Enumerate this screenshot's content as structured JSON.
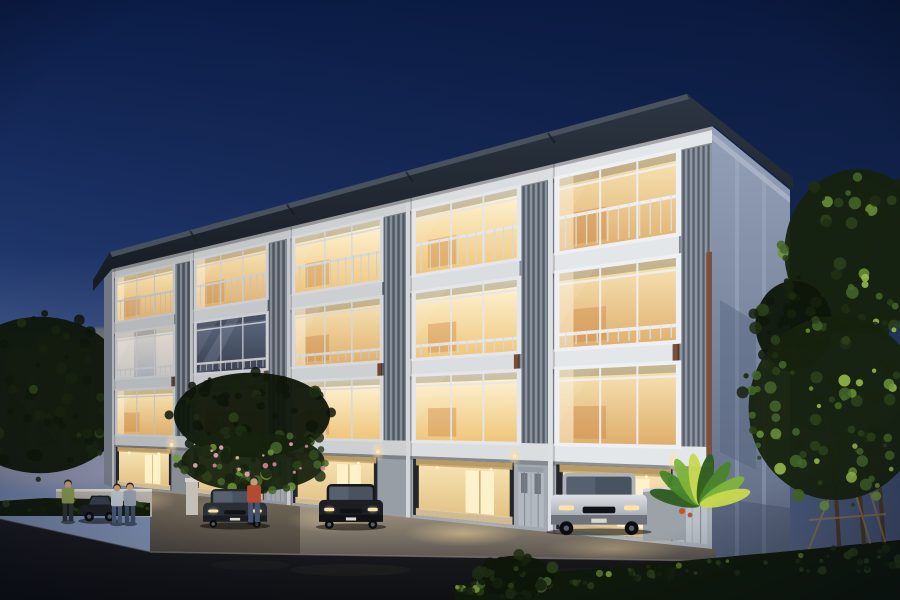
{
  "image": {
    "subject": "Modern four-storey townhome row at dusk - exterior architectural rendering",
    "width": 900,
    "height": 600
  },
  "palette": {
    "sky_top": "#0b1d49",
    "sky_upper": "#1f366b",
    "sky_mid": "#5c71a1",
    "sky_horizon": "#a6b4cf",
    "horizon_warm": "#c2ab9b",
    "roof_dark": "#161b22",
    "roof_mid": "#2c3642",
    "roof_top": "#4b5663",
    "fascia": "#e4e7ea",
    "wall": "#a9b0b7",
    "wall_recess": "#8b95a3",
    "pilaster": "#dcdfe3",
    "louver_base": "#6c7581",
    "louver_lit": "#b7bfc9",
    "louver_dark": "#2e343c",
    "brown_hi": "#7a5138",
    "brown_lo": "#53362a",
    "side_wall_hi": "#93a0b8",
    "side_wall_lo": "#5f6c84",
    "glass_bright_hi": "#fff6d9",
    "glass_bright_lo": "#efc57b",
    "glass_warm_hi": "#f8e6b8",
    "glass_warm_lo": "#dfae6c",
    "glass_dim_hi": "#d8d2ca",
    "glass_dim_lo": "#a8abb5",
    "glass_dark_hi": "#5d6880",
    "glass_dark_lo": "#3a4252",
    "interior_hi": "#f7e3b2",
    "interior_lo": "#e3c183",
    "door_glow": "#fff2cc",
    "concrete_hi": "#b9a98e",
    "concrete_lo": "#57514a",
    "asphalt_hi": "#1d1e23",
    "asphalt_lo": "#101114",
    "curb": "#8a857a",
    "gate_panel": "#b9c0c7",
    "gate_groove": "#7f8893",
    "low_wall": "#b2aea6",
    "glow_warm": "#ffdf9e",
    "tree_dark1": "#0e1609",
    "tree_dark2": "#16220e",
    "tree_dark3": "#1f2e13",
    "tree_mid1": "#2c421a",
    "tree_mid2": "#45662a",
    "tree_lit1": "#6d9437",
    "tree_lit2": "#9dc04c",
    "pink1": "#d2849c",
    "pink2": "#e8a7b8",
    "trunk": "#4b3826",
    "support": "#8a744e",
    "city_haze": "#978f86",
    "city_tower": "#7b7470",
    "city_window": "#e8a050",
    "skin": "#c49a7d",
    "hair": "#2a241d"
  },
  "scene": {
    "city": {
      "name": "distant-city-skyline",
      "towers": [
        [
          8,
          352,
          20,
          95
        ],
        [
          36,
          333,
          28,
          114
        ],
        [
          68,
          342,
          22,
          105
        ],
        [
          95,
          328,
          32,
          119
        ],
        [
          131,
          356,
          24,
          91
        ],
        [
          157,
          368,
          17,
          79
        ]
      ]
    },
    "building": {
      "name": "townhome-row",
      "geometry": {
        "bounds_x": [
          112,
          190,
          287,
          406,
          548,
          712
        ],
        "y_top_left": 266,
        "y_top_right": 118,
        "y_bot_left": 487,
        "y_bot_right": 549,
        "roof_outer": [
          [
            93,
            280
          ],
          [
            110,
            252
          ],
          [
            687,
            94
          ],
          [
            793,
            178
          ]
        ],
        "roof_inner": [
          [
            793,
            190
          ],
          [
            714,
            126
          ],
          [
            112,
            269
          ],
          [
            93,
            291
          ]
        ],
        "side_wall": {
          "corner_x": 712,
          "right_x": 790,
          "top_y_corner": 126,
          "top_y_right": 190,
          "bottom_y": 556
        }
      },
      "unit_brightness": [
        0.8,
        0.86,
        0.9,
        0.96,
        1.0
      ],
      "units": [
        {
          "name": "unit-1",
          "f4": "warm",
          "f3": "dim",
          "f2": "warm",
          "carport": "lit",
          "gate": false,
          "car": null
        },
        {
          "name": "unit-2",
          "f4": "warm",
          "f3": "dark",
          "f2": "warm",
          "carport": "lit",
          "gate": true,
          "car": "sedan"
        },
        {
          "name": "unit-3",
          "f4": "bright",
          "f3": "warm",
          "f2": "bright",
          "carport": "lit",
          "gate": false,
          "car": "sedan"
        },
        {
          "name": "unit-4",
          "f4": "bright",
          "f3": "bright",
          "f2": "bright",
          "carport": "lit",
          "gate": true,
          "car": null
        },
        {
          "name": "unit-5",
          "f4": "warm",
          "f3": "warm",
          "f2": "warm",
          "carport": "lit",
          "gate": true,
          "car": "suv"
        }
      ]
    },
    "vehicles": [
      {
        "name": "street-parked-car",
        "kind": "side",
        "x": 80,
        "y": 492,
        "w": 38,
        "h": 30,
        "body": "#1d2126"
      },
      {
        "name": "carport-sedan-dark",
        "kind": "front",
        "x": 203,
        "y": 489,
        "w": 64,
        "h": 38,
        "body": "#2a2e35"
      },
      {
        "name": "carport-sedan-black",
        "kind": "front",
        "x": 319,
        "y": 484,
        "w": 64,
        "h": 44,
        "body": "#1b1e23"
      },
      {
        "name": "carport-suv-silver",
        "kind": "suv",
        "x": 551,
        "y": 473,
        "w": 96,
        "h": 60,
        "body": "#c7cbd1"
      }
    ],
    "people": [
      {
        "name": "pedestrian-walking",
        "x": 68,
        "y": 480,
        "h": 42,
        "shirt": "#86994d",
        "pants": "#2e3336"
      },
      {
        "name": "resident-pair-left",
        "x": 117,
        "y": 484,
        "h": 40,
        "shirt": "#b9c0c9",
        "pants": "#4a5b78"
      },
      {
        "name": "resident-pair-right",
        "x": 130,
        "y": 483,
        "h": 41,
        "shirt": "#8f9aa8",
        "pants": "#3c4c66"
      },
      {
        "name": "resident-red-shirt",
        "x": 254,
        "y": 477,
        "h": 46,
        "shirt": "#b44a31",
        "pants": "#44536e"
      }
    ],
    "road": {
      "name": "street",
      "edge": [
        [
          0,
          519
        ],
        [
          150,
          552
        ],
        [
          716,
          561
        ],
        [
          900,
          558
        ]
      ]
    },
    "walls": {
      "left_wall": [
        56,
        489,
        96,
        26
      ],
      "left_pillar": [
        186,
        481,
        12,
        34
      ],
      "right_wall": [
        643,
        485,
        43,
        56
      ]
    },
    "vegetation": [
      {
        "name": "left-tree-mass",
        "style": "cluster",
        "cx": 40,
        "cy": 395,
        "rx": 100,
        "ry": 85,
        "n": 70,
        "seed": 11,
        "lit": 0
      },
      {
        "name": "mid-tree",
        "style": "cluster",
        "cx": 252,
        "cy": 415,
        "rx": 85,
        "ry": 46,
        "n": 60,
        "seed": 21,
        "lit": 0.2
      },
      {
        "name": "flower-shrub",
        "style": "flower",
        "cx": 253,
        "cy": 462,
        "rx": 78,
        "ry": 32,
        "n": 70,
        "seed": 31,
        "lit": 0.8
      },
      {
        "name": "right-tree-upper",
        "style": "cluster",
        "cx": 858,
        "cy": 252,
        "rx": 80,
        "ry": 90,
        "n": 80,
        "seed": 41,
        "lit": 0.5
      },
      {
        "name": "right-tree-lower",
        "style": "cluster",
        "cx": 836,
        "cy": 408,
        "rx": 95,
        "ry": 100,
        "n": 110,
        "seed": 51,
        "lit": 1.2
      },
      {
        "name": "right-tree-small",
        "style": "cluster",
        "cx": 794,
        "cy": 325,
        "rx": 42,
        "ry": 48,
        "n": 40,
        "seed": 61,
        "lit": 0.3
      },
      {
        "name": "center-bush",
        "style": "cluster",
        "cx": 516,
        "cy": 576,
        "rx": 42,
        "ry": 22,
        "n": 40,
        "seed": 71,
        "lit": 0.5
      },
      {
        "name": "tropical-plant",
        "style": "tropical",
        "cx": 700,
        "cy": 505
      },
      {
        "name": "hedge-right",
        "style": "hedge",
        "seed": 81
      },
      {
        "name": "hedge-left",
        "style": "hedge-left",
        "seed": 91
      }
    ]
  }
}
